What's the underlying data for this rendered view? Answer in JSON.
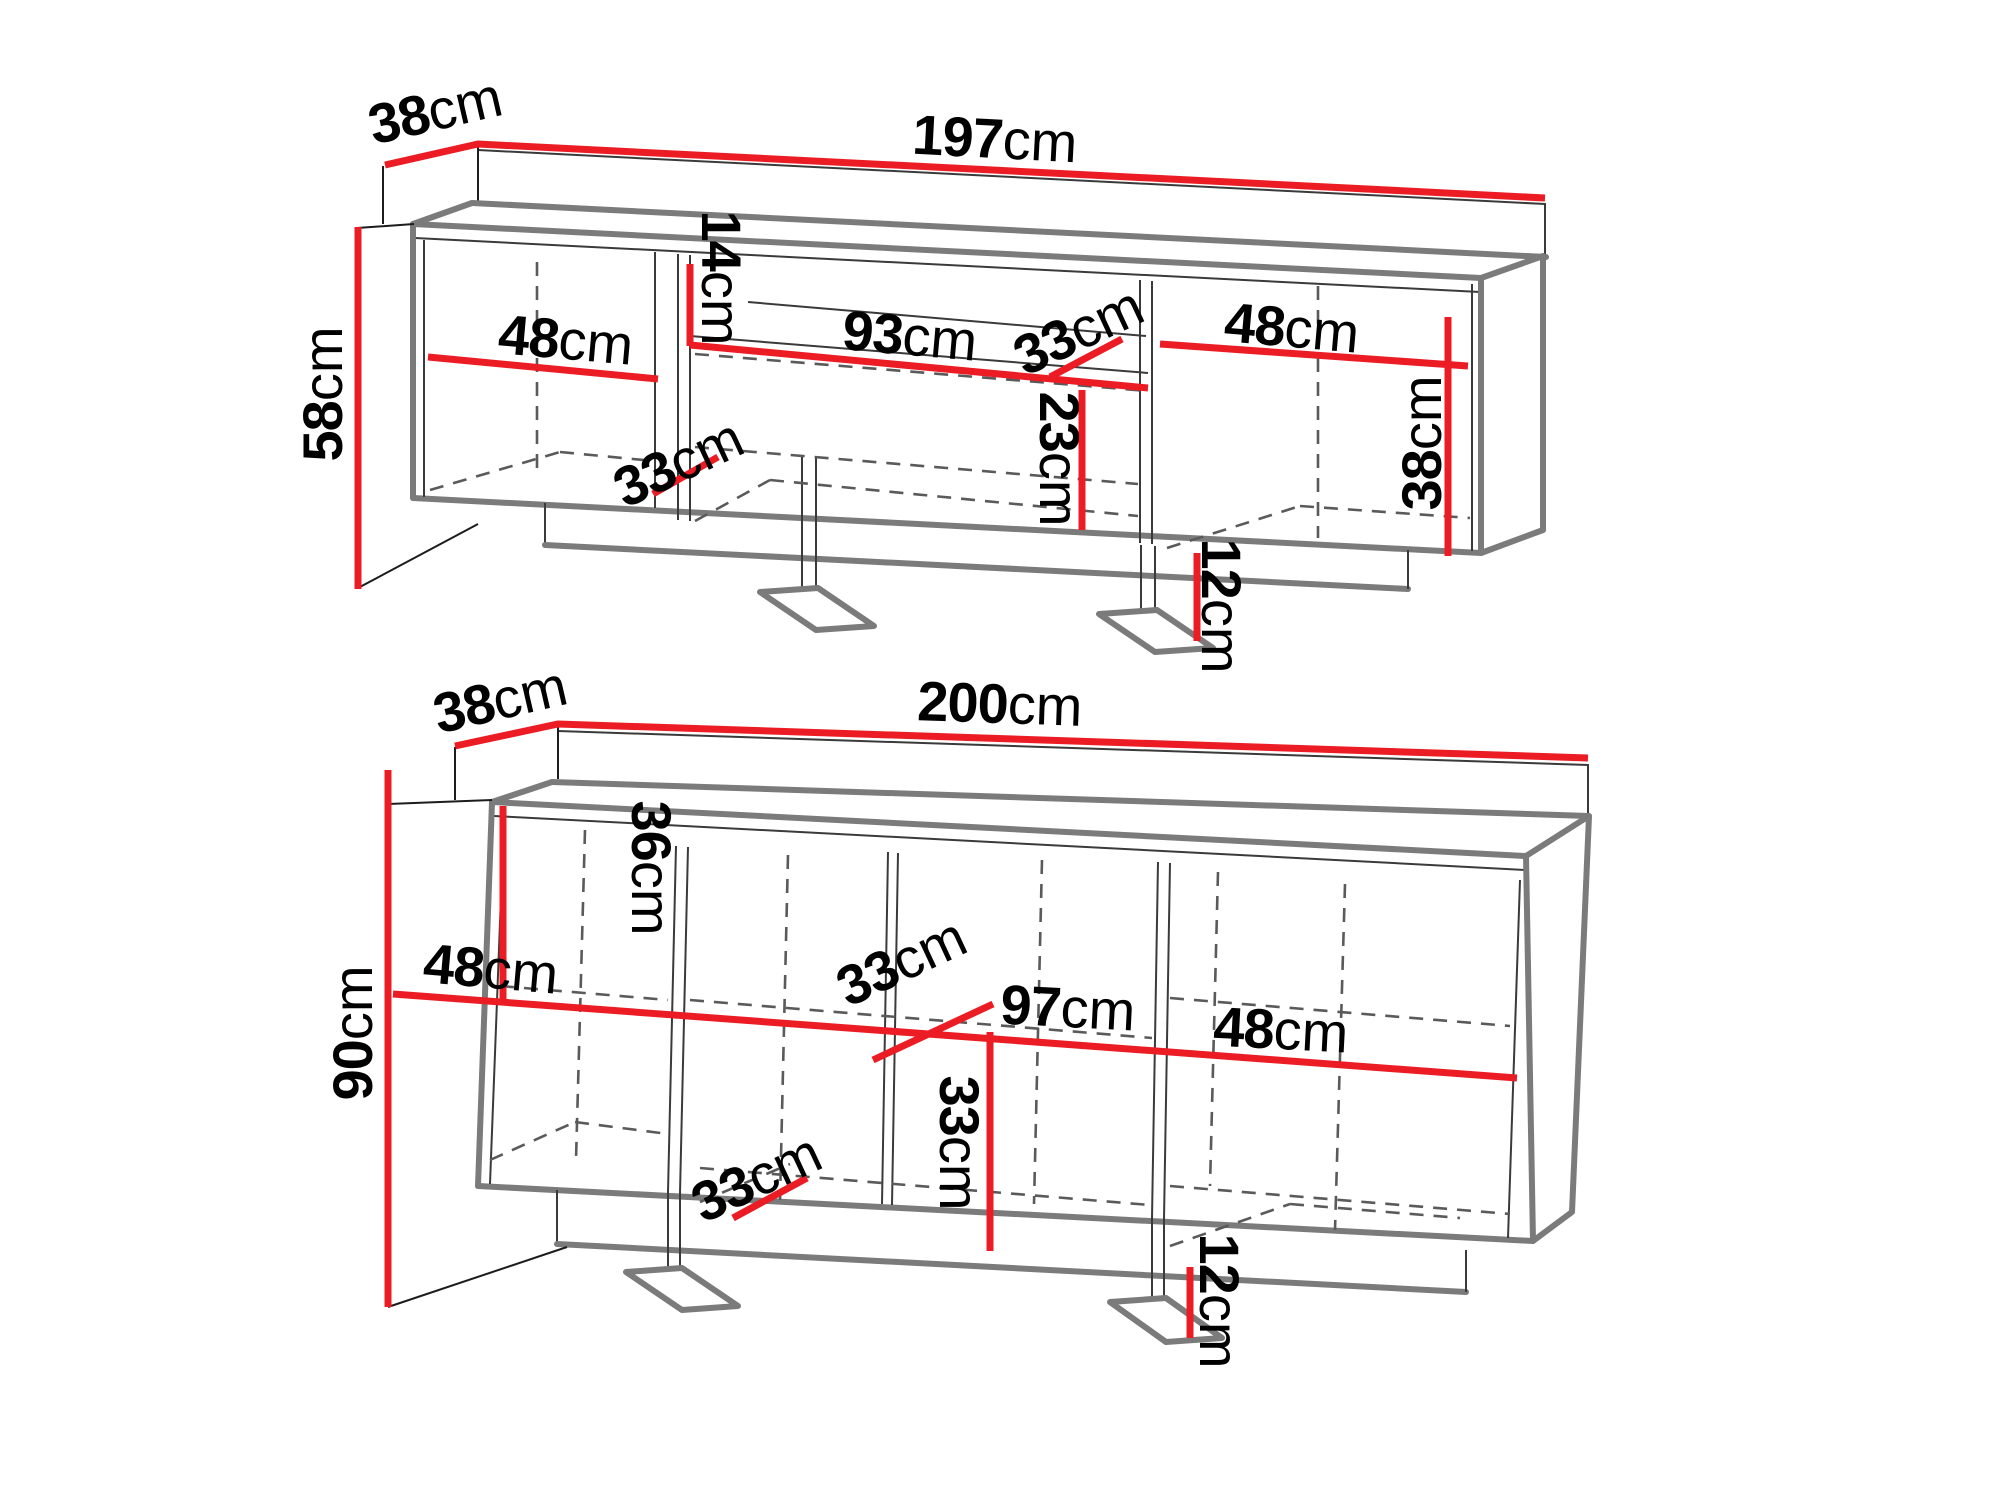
{
  "colors": {
    "dimension_red": "#ec1c24",
    "outline_gray": "#7b7b7b",
    "inner_line": "#3a3a3a",
    "dashed_gray": "#5a5a5a",
    "label_black": "#000000",
    "background": "#ffffff"
  },
  "units": {
    "tv_stand": {
      "label": "tv-stand",
      "dims": [
        {
          "name": "depth",
          "num": "38",
          "unit": "cm"
        },
        {
          "name": "width",
          "num": "197",
          "unit": "cm"
        },
        {
          "name": "height",
          "num": "58",
          "unit": "cm"
        },
        {
          "name": "left-section-width",
          "num": "48",
          "unit": "cm"
        },
        {
          "name": "shelf-gap-height",
          "num": "14",
          "unit": "cm"
        },
        {
          "name": "niche-width",
          "num": "93",
          "unit": "cm"
        },
        {
          "name": "niche-depth",
          "num": "33",
          "unit": "cm"
        },
        {
          "name": "right-section-width",
          "num": "48",
          "unit": "cm"
        },
        {
          "name": "bottom-shelf-depth",
          "num": "33",
          "unit": "cm"
        },
        {
          "name": "niche-height",
          "num": "23",
          "unit": "cm"
        },
        {
          "name": "right-inner-height",
          "num": "38",
          "unit": "cm"
        },
        {
          "name": "foot-height",
          "num": "12",
          "unit": "cm"
        }
      ]
    },
    "sideboard": {
      "label": "sideboard",
      "dims": [
        {
          "name": "depth",
          "num": "38",
          "unit": "cm"
        },
        {
          "name": "width",
          "num": "200",
          "unit": "cm"
        },
        {
          "name": "height",
          "num": "90",
          "unit": "cm"
        },
        {
          "name": "top-gap-height",
          "num": "36",
          "unit": "cm"
        },
        {
          "name": "left-section-width",
          "num": "48",
          "unit": "cm"
        },
        {
          "name": "shelf-depth",
          "num": "33",
          "unit": "cm"
        },
        {
          "name": "middle-width",
          "num": "97",
          "unit": "cm"
        },
        {
          "name": "right-section-width",
          "num": "48",
          "unit": "cm"
        },
        {
          "name": "floor-depth",
          "num": "33",
          "unit": "cm"
        },
        {
          "name": "lower-inner-height",
          "num": "33",
          "unit": "cm"
        },
        {
          "name": "foot-height",
          "num": "12",
          "unit": "cm"
        }
      ]
    }
  }
}
